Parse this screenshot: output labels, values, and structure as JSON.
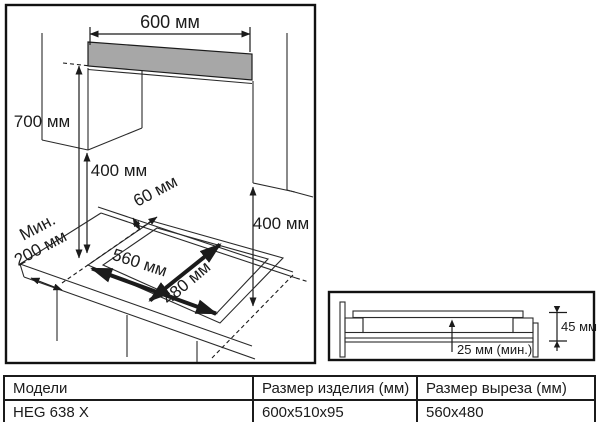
{
  "colors": {
    "line": "#1b1b1b",
    "hood_fill": "#a7a7a7",
    "background": "#ffffff"
  },
  "main_diagram": {
    "hood_width": "600 мм",
    "hood_to_hob": "700 мм",
    "left_cabinet_clearance": "400 мм",
    "right_cabinet_clearance": "400 мм",
    "cutout_to_back_edge": "60 мм",
    "min_side_clearance_line1": "Мин.",
    "min_side_clearance_line2": "200 мм",
    "cutout_width": "560 мм",
    "cutout_depth": "480 мм"
  },
  "inset_diagram": {
    "installed_depth": "45 мм",
    "min_bottom_clearance": "25 мм (мин.)"
  },
  "table": {
    "headers": [
      "Модели",
      "Размер изделия (мм)",
      "Размер выреза (мм)"
    ],
    "rows": [
      [
        "HEG 638 X",
        "600x510x95",
        "560x480"
      ]
    ]
  }
}
